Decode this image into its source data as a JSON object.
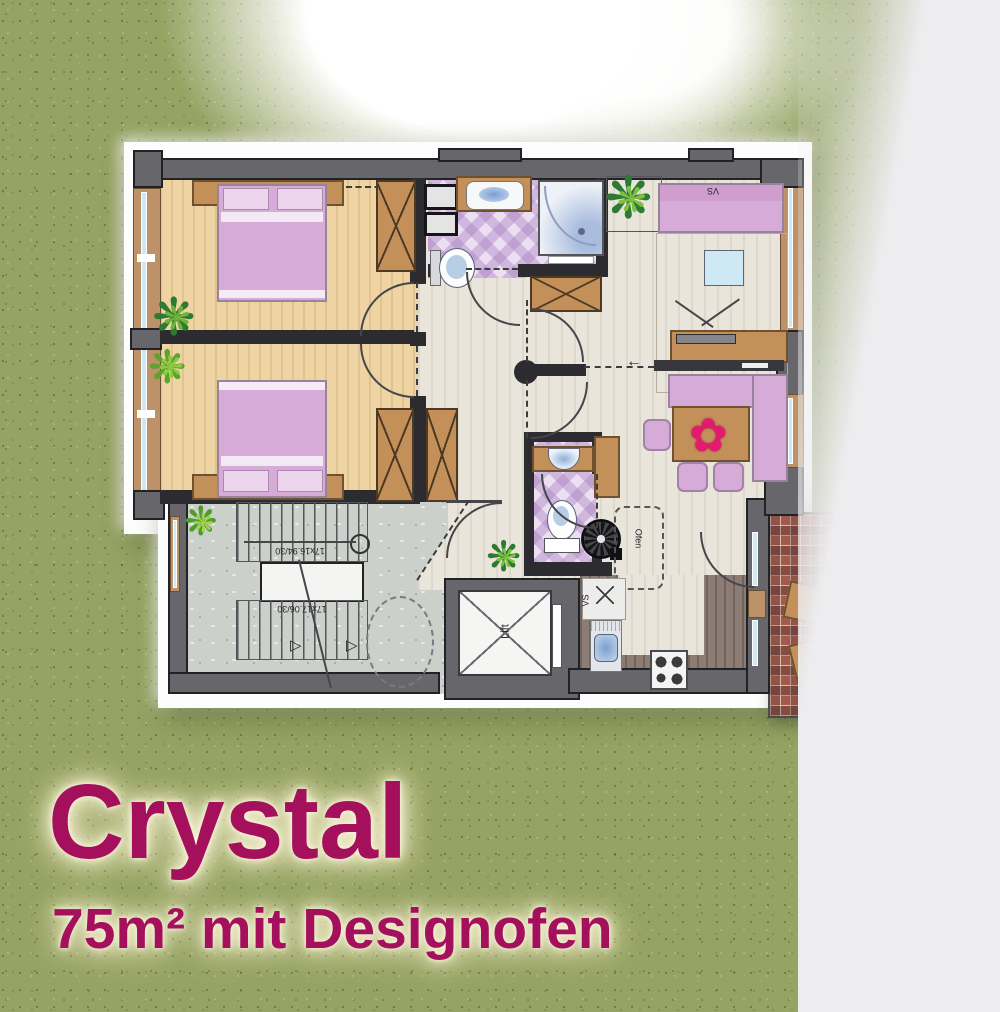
{
  "title_block": {
    "title": "Crystal",
    "subtitle": "75m² mit Designofen"
  },
  "plan_labels": {
    "sofa_bed": "VS",
    "oven": "Ofen",
    "kitchen_unit": "VS",
    "lift": "Lift",
    "stairs_upper": "17x16.94/30",
    "stairs_lower": "17x17.06/30"
  },
  "icons": {
    "slide_arrow": "←",
    "stair_arrow": "▷",
    "plant": "❋",
    "flower": "✿"
  },
  "colors": {
    "accent_text": "#a5105c",
    "wall": "#67676b",
    "wall_dark": "#2c2c30",
    "bedroom_floor": "#efd4a3",
    "hall_floor": "#eae5da",
    "kitchen_floor": "#8d7c74",
    "bath_tile": "#d9c3e6",
    "furniture_pink": "#d7abd7",
    "wood": "#c3905a",
    "window_glass": "#cfe9f4",
    "stair_concrete": "#cbd0ca",
    "balcony_tile": "#a1584c",
    "grass": "#96a363"
  }
}
